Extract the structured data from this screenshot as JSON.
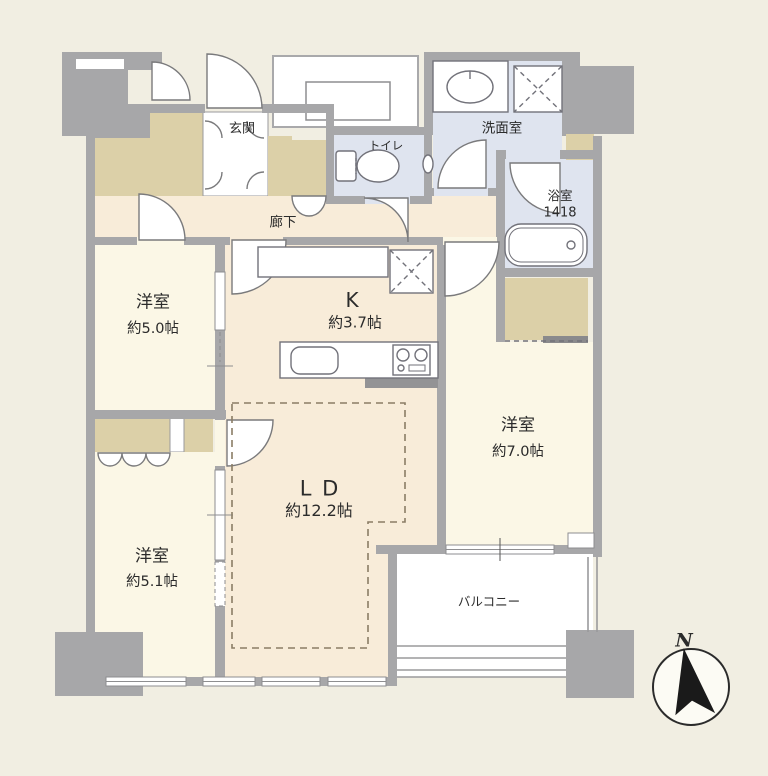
{
  "plan": {
    "entrance": {
      "label": "玄関"
    },
    "toilet": {
      "label": "トイレ"
    },
    "washroom": {
      "label": "洗面室"
    },
    "bathroom": {
      "label": "浴室",
      "size": "1418"
    },
    "corridor": {
      "label": "廊下"
    },
    "kitchen": {
      "label": "K",
      "area": "約3.7帖"
    },
    "living_dining": {
      "label": "L D",
      "area": "約12.2帖"
    },
    "bedroom_5_0": {
      "label": "洋室",
      "area": "約5.0帖"
    },
    "bedroom_7_0": {
      "label": "洋室",
      "area": "約7.0帖"
    },
    "bedroom_5_1": {
      "label": "洋室",
      "area": "約5.1帖"
    },
    "balcony": {
      "label": "バルコニー"
    },
    "compass": {
      "label": "N"
    },
    "colors": {
      "background": "#f1eee2",
      "wall": "#a7a7a9",
      "floor_bedroom": "#fbf7e6",
      "floor_ldk": "#f8ecd9",
      "floor_closet": "#dcd0a8",
      "floor_wet": "#dfe4ef",
      "fixture_line": "#72727a"
    }
  }
}
